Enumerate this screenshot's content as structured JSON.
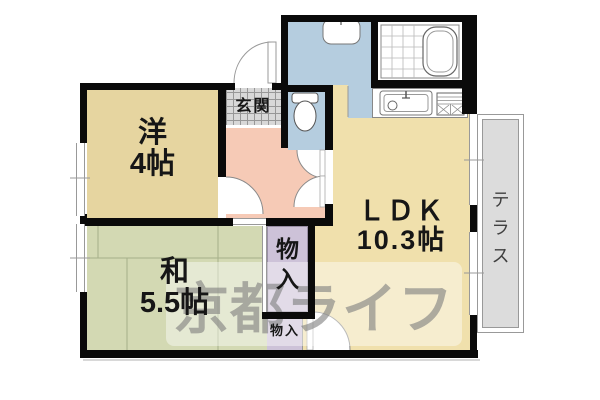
{
  "floorplan": {
    "title": "apartment-floor-plan",
    "watermark": {
      "text": "京都ライフ",
      "color": "#7d7d7d"
    },
    "rooms": {
      "western": {
        "name": "洋",
        "size": "4帖"
      },
      "japanese": {
        "name": "和",
        "size": "5.5帖"
      },
      "ldk": {
        "name": "ＬＤＫ",
        "size": "10.3帖"
      },
      "entrance": {
        "label": "玄関"
      },
      "closet_large": {
        "chars": [
          "物",
          "入"
        ]
      },
      "closet_small": {
        "label": "物入"
      },
      "terrace": {
        "chars": [
          "テ",
          "ラ",
          "ス"
        ]
      }
    },
    "colors": {
      "wall": "#0a0a0a",
      "western_room": "#e6d5a0",
      "japanese_room": "#d3d9b3",
      "ldk_room": "#f0e0ac",
      "hallway": "#f6cab6",
      "water_rooms": "#b5cddf",
      "closet": "#cdc2d8",
      "entrance_tile": "#d8d8d8",
      "terrace": "#dcdcdc"
    },
    "fixtures": [
      "bathtub-icon",
      "washbasin-icon",
      "toilet-icon",
      "kitchen-sink-icon",
      "stove-icon"
    ]
  }
}
